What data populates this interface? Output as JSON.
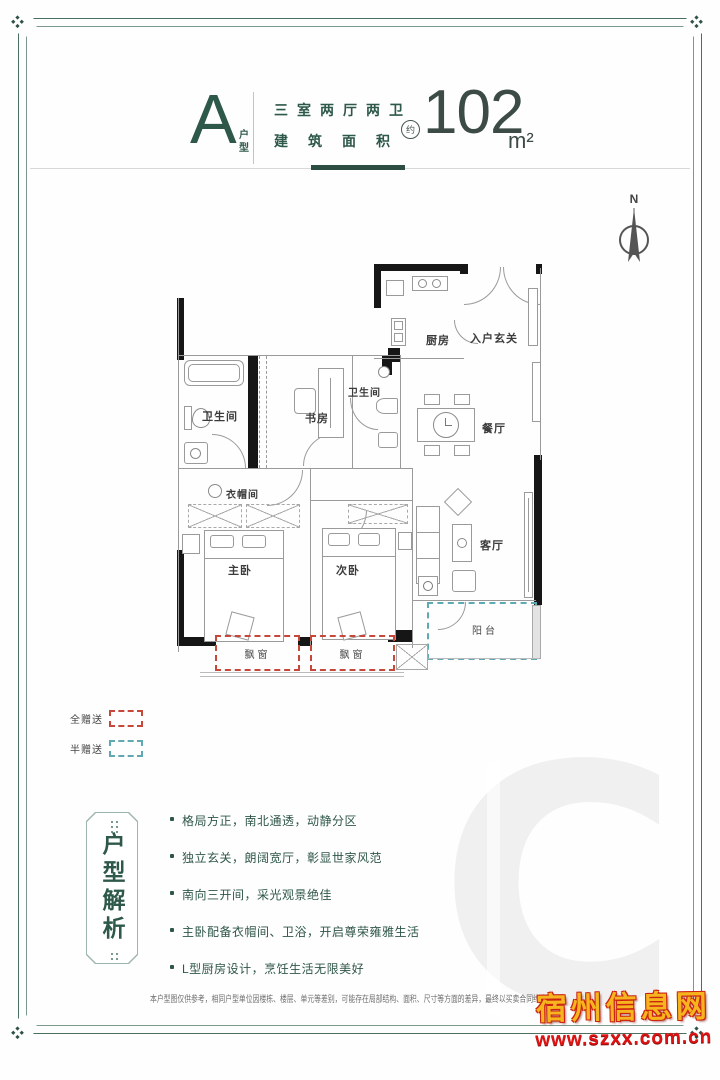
{
  "header": {
    "unit_letter": "A",
    "unit_label": "户型",
    "spec_line": "三室两厅两卫",
    "area_label": "建筑面积",
    "approx_label": "约",
    "area_value": "102",
    "area_unit": "m²"
  },
  "compass": {
    "north_label": "N"
  },
  "floorplan": {
    "rooms": {
      "kitchen": "厨房",
      "entrance": "入户玄关",
      "bath_left": "卫生间",
      "bath_mid": "卫生间",
      "study": "书房",
      "dining": "餐厅",
      "cloakroom": "衣帽间",
      "master_bedroom": "主卧",
      "second_bedroom": "次卧",
      "living_room": "客厅",
      "balcony": "阳台",
      "bay_window_1": "飘窗",
      "bay_window_2": "飘窗"
    }
  },
  "legend": {
    "full_gift_label": "全赠送",
    "half_gift_label": "半赠送",
    "full_gift_color": "#c8473b",
    "half_gift_color": "#5fa9b3"
  },
  "analysis": {
    "title": "户型解析",
    "bullets": [
      "格局方正，南北通透，动静分区",
      "独立玄关，朗阔宽厅，彰显世家风范",
      "南向三开间，采光观景绝佳",
      "主卧配备衣帽间、卫浴，开启尊荣雍雅生活",
      "L型厨房设计，烹饪生活无限美好"
    ]
  },
  "footer": {
    "disclaimer": "本户型图仅供参考，相同户型单位因楼栋、楼层、单元等差别，可能存在局部结构、面积、尺寸等方面的差异，最终以买卖合同约定为准。"
  },
  "watermark": {
    "site_name": "宿州信息网",
    "site_url": "www.szxx.com.cn",
    "logo_letter": "C"
  },
  "theme": {
    "accent_green": "#2e5849",
    "wall_black": "#161616"
  }
}
